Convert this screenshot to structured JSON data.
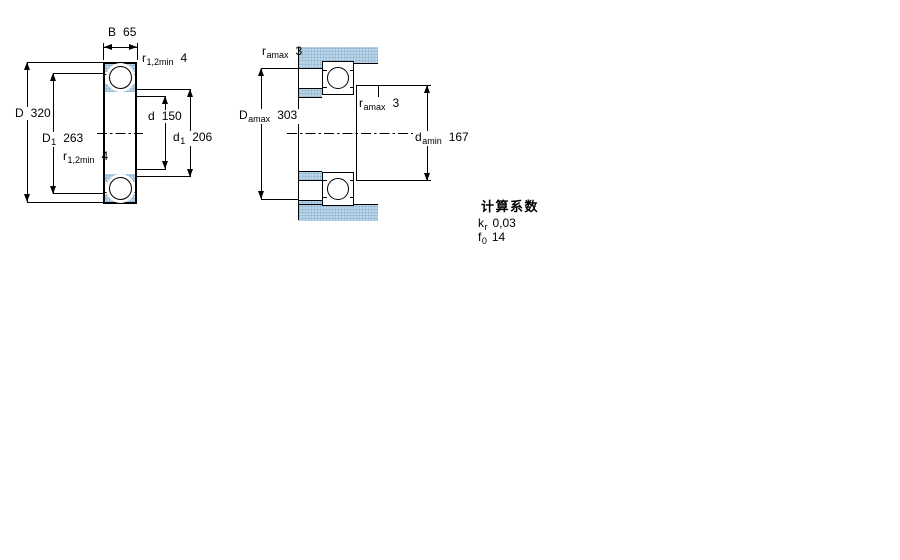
{
  "figure1": {
    "description": "bearing cross-section with boundary dimensions",
    "b": {
      "base": "B",
      "value": "65"
    },
    "r12_top": {
      "base": "r",
      "sub": "1,2min",
      "value": "4"
    },
    "r12_bottom": {
      "base": "r",
      "sub": "1,2min",
      "value": "4"
    },
    "D": {
      "base": "D",
      "value": "320"
    },
    "D1": {
      "base": "D",
      "sub": "1",
      "value": "263"
    },
    "d": {
      "base": "d",
      "value": "150"
    },
    "d1": {
      "base": "d",
      "sub": "1",
      "value": "206"
    }
  },
  "figure2": {
    "description": "bearing mounted with abutment dimensions",
    "ramax_top": {
      "base": "r",
      "sub": "amax",
      "value": "3"
    },
    "Damax": {
      "base": "D",
      "sub": "amax",
      "value": "303"
    },
    "ramax_right": {
      "base": "r",
      "sub": "amax",
      "value": "3"
    },
    "damin": {
      "base": "d",
      "sub": "amin",
      "value": "167"
    }
  },
  "calc_factors": {
    "title": "计算系数",
    "kr": {
      "base": "k",
      "sub": "r",
      "value": "0,03"
    },
    "f0": {
      "base": "f",
      "sub": "0",
      "value": "14"
    }
  },
  "colors": {
    "hatch_base": "#bcd4e7",
    "hatch_dot": "#8cb4d1",
    "line": "#000000",
    "background": "#ffffff"
  }
}
